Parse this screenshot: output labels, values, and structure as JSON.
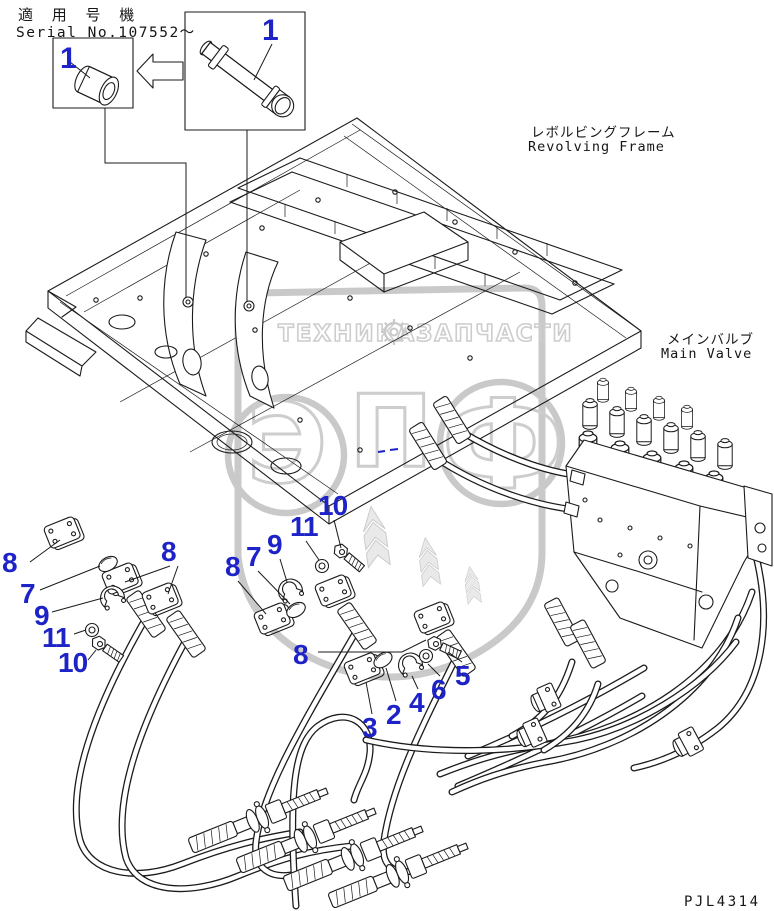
{
  "header": {
    "model_label_jp": "適 用 号 機",
    "serial_label": "Serial No.107552〜"
  },
  "labels": {
    "revolving_frame_jp": "レボルビングフレーム",
    "revolving_frame_en": "Revolving Frame",
    "main_valve_jp": "メインバルブ",
    "main_valve_en": "Main Valve",
    "drawing_code": "PJL4314"
  },
  "watermark": {
    "letters": [
      "Э",
      "П",
      "Ф"
    ],
    "tagline_left": "ТЕХНИКА",
    "tagline_right": "ЗАПЧАСТИ"
  },
  "callouts": [
    {
      "n": "1"
    },
    {
      "n": "1"
    },
    {
      "n": "8"
    },
    {
      "n": "7"
    },
    {
      "n": "9"
    },
    {
      "n": "11"
    },
    {
      "n": "10"
    },
    {
      "n": "8"
    },
    {
      "n": "8"
    },
    {
      "n": "7"
    },
    {
      "n": "9"
    },
    {
      "n": "11"
    },
    {
      "n": "10"
    },
    {
      "n": "8"
    },
    {
      "n": "3"
    },
    {
      "n": "2"
    },
    {
      "n": "4"
    },
    {
      "n": "6"
    },
    {
      "n": "5"
    }
  ]
}
